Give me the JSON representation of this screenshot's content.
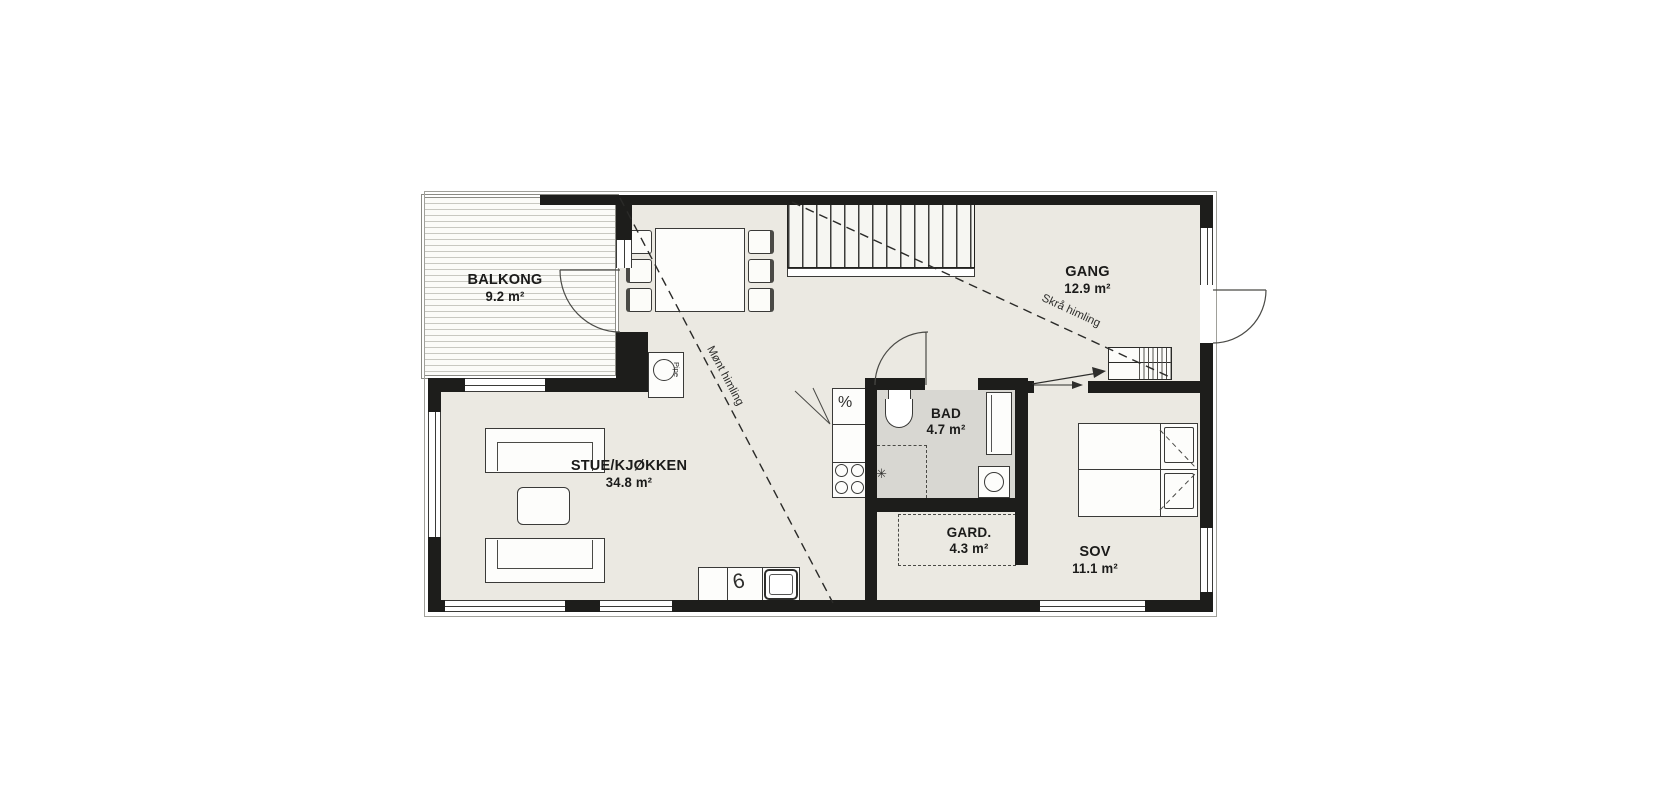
{
  "plan": {
    "title": "Floor plan",
    "rooms": [
      {
        "key": "balkong",
        "label": "BALKONG",
        "area": "9.2 m²"
      },
      {
        "key": "stue_kjokken",
        "label": "STUE/KJØKKEN",
        "area": "34.8 m²"
      },
      {
        "key": "gang",
        "label": "GANG",
        "area": "12.9 m²"
      },
      {
        "key": "bad",
        "label": "BAD",
        "area": "4.7 m²"
      },
      {
        "key": "garderobe",
        "label": "GARD.",
        "area": "4.3 m²"
      },
      {
        "key": "soverom",
        "label": "SOV",
        "area": "11.1 m²"
      }
    ],
    "ceiling_notes": [
      {
        "key": "mont_himling",
        "label": "Mønt himling"
      },
      {
        "key": "skra_himling",
        "label": "Skrå himling"
      }
    ],
    "fixtures": {
      "chimney_label": "Pipe",
      "dishwasher_glyph": "%",
      "faucet_glyph": "6",
      "shower_glyph": "✳"
    },
    "colors": {
      "wall": "#1d1d1b",
      "floor": "#ebe9e2",
      "bathroom_floor": "#d8d7d2",
      "deck_stripe": "#c8c8c1",
      "line": "#3a3a38"
    }
  }
}
